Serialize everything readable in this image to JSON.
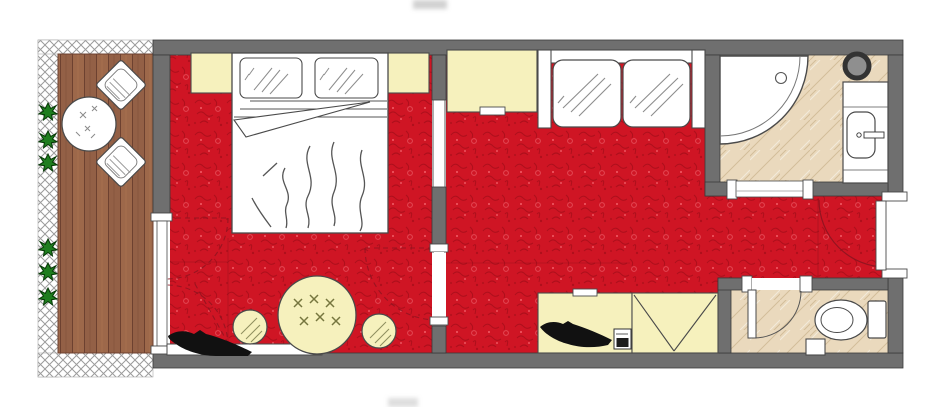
{
  "colors": {
    "wall": "#6f6f6f",
    "wall_outline": "#3a3a3a",
    "carpet": "#cf1524",
    "carpet_dark": "#8f0a14",
    "carpet_light": "#ff7d84",
    "carpet_ring": "#e85560",
    "furniture": "#f6f1bd",
    "outline": "#4a4a4a",
    "tile": "#ead9bd",
    "tile_line": "#cdb691",
    "wood_a": "#9d684a",
    "wood_b": "#936046",
    "wood_line": "#6d4130",
    "plant": "#1e7d1e",
    "plant_dark": "#063906",
    "hatch_line": "#9b9b9b",
    "swing": "#8c1420",
    "fixture": "#8f8f8f"
  },
  "plan": {
    "rooms": [
      {
        "name": "balcony",
        "floor": "wood-deck"
      },
      {
        "name": "bedroom",
        "floor": "red-carpet"
      },
      {
        "name": "living-area",
        "floor": "red-carpet"
      },
      {
        "name": "entry-hall",
        "floor": "red-carpet"
      },
      {
        "name": "bathroom",
        "floor": "beige-tile"
      },
      {
        "name": "wc",
        "floor": "beige-tile"
      }
    ],
    "furniture": [
      {
        "name": "balcony-table",
        "room": "balcony",
        "count": 1
      },
      {
        "name": "balcony-chair",
        "room": "balcony",
        "count": 2
      },
      {
        "name": "plant",
        "room": "balcony",
        "count": 6
      },
      {
        "name": "double-bed",
        "room": "bedroom",
        "count": 1
      },
      {
        "name": "pillow",
        "room": "bedroom",
        "count": 2
      },
      {
        "name": "nightstand",
        "room": "bedroom",
        "count": 2
      },
      {
        "name": "tv-console",
        "room": "bedroom",
        "count": 1
      },
      {
        "name": "tv-silhouette",
        "room": "bedroom",
        "count": 1
      },
      {
        "name": "round-table",
        "room": "bedroom",
        "count": 1
      },
      {
        "name": "stool",
        "room": "bedroom",
        "count": 2
      },
      {
        "name": "wardrobe",
        "room": "living-area",
        "count": 1
      },
      {
        "name": "sofa-two-seat",
        "room": "living-area",
        "count": 1
      },
      {
        "name": "desk",
        "room": "living-area",
        "count": 1
      },
      {
        "name": "tv-silhouette",
        "room": "living-area",
        "count": 1
      },
      {
        "name": "minibar-safe",
        "room": "living-area",
        "count": 1
      },
      {
        "name": "luggage-rack",
        "room": "living-area",
        "count": 1
      },
      {
        "name": "corner-shower",
        "room": "bathroom",
        "count": 1
      },
      {
        "name": "washbasin-vanity",
        "room": "bathroom",
        "count": 1
      },
      {
        "name": "round-fixture",
        "room": "bathroom",
        "count": 1
      },
      {
        "name": "toilet",
        "room": "wc",
        "count": 1
      },
      {
        "name": "waste-bin",
        "room": "wc",
        "count": 1
      }
    ],
    "doors": [
      {
        "name": "balcony-door",
        "between": [
          "balcony",
          "bedroom"
        ],
        "swing": "dashed-double-arc"
      },
      {
        "name": "bedroom-living-opening",
        "between": [
          "bedroom",
          "living-area"
        ],
        "swing": "dashed-arc"
      },
      {
        "name": "bathroom-door",
        "between": [
          "entry-hall",
          "bathroom"
        ],
        "swing": "none-shown"
      },
      {
        "name": "wc-door",
        "between": [
          "entry-hall",
          "wc"
        ],
        "swing": "quarter-arc"
      },
      {
        "name": "entry-door",
        "between": [
          "outside",
          "entry-hall"
        ],
        "swing": "quarter-arc"
      }
    ]
  }
}
